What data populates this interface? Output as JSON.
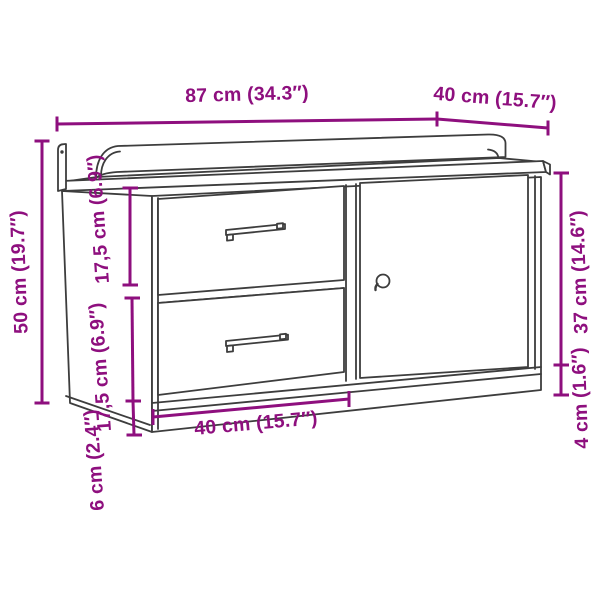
{
  "diagram": {
    "subject": "storage bench with two drawers and one door",
    "style": "line-art dimension drawing"
  },
  "palette": {
    "dimension_color": "#8e0f7e",
    "outline_color": "#3d3d3d",
    "background": "#ffffff"
  },
  "dimension_labels": [
    {
      "id": "top-width",
      "text": "87 cm (34.3″)"
    },
    {
      "id": "top-depth",
      "text": "40 cm (15.7″)"
    },
    {
      "id": "left-total-height",
      "text": "50 cm (19.7″)"
    },
    {
      "id": "upper-drawer-height",
      "text": "17,5 cm (6.9″)"
    },
    {
      "id": "lower-drawer-height",
      "text": "17,5 cm (6.9″)"
    },
    {
      "id": "front-base-height",
      "text": "6 cm (2.4″)"
    },
    {
      "id": "bottom-drawer-width",
      "text": "40 cm (15.7″)"
    },
    {
      "id": "right-door-height",
      "text": "37 cm (14.6″)"
    },
    {
      "id": "right-base-height",
      "text": "4 cm (1.6″)"
    }
  ]
}
